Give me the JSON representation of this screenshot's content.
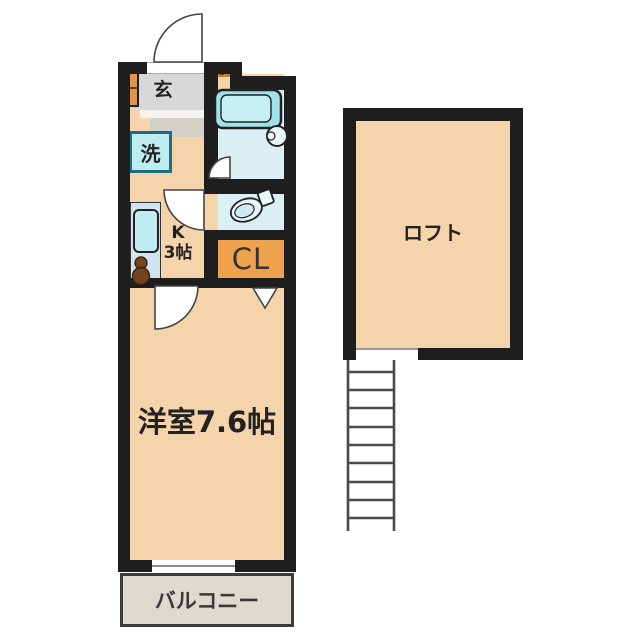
{
  "colors": {
    "wall": "#1e1e1e",
    "floor": "#f5d3ab",
    "wet": "#d9eff3",
    "tub": "#9fe2ec",
    "tubInner": "#c7f0f6",
    "counter": "#cfe3f0",
    "sink": "#bdecf3",
    "closetOrange": "#efa24d",
    "cabinetOrange": "#dd9549",
    "genkanGray": "#d8d8d8",
    "stepGray": "#d3d0c8",
    "balconyFill": "#dfdacf",
    "tealBorder": "#1d6e80",
    "stoveBrown": "#74431f",
    "text": "#222222"
  },
  "labels": {
    "entrance": "玄",
    "washer": "洗",
    "kitchen_line1": "K",
    "kitchen_line2": "3帖",
    "closet": "CL",
    "main_room": "洋室7.6帖",
    "balcony": "バルコニー",
    "loft": "ロフト"
  }
}
